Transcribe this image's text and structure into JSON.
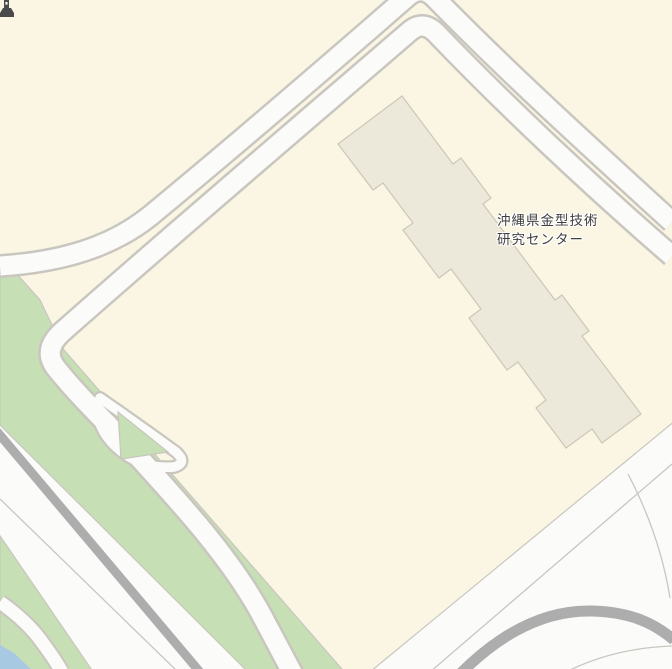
{
  "map": {
    "poi": {
      "label_line1": "沖縄県金型技術",
      "label_line2": "研究センター",
      "icon": "factory-building-icon"
    },
    "features": {
      "block": "city-block-diamond",
      "building": "research-center-building",
      "roads": [
        "dual-carriageway-northwest",
        "dual-carriageway-northeast",
        "spur-road-southwest",
        "highway-bundle-bottom-left",
        "interchange-southeast",
        "coastal-road-bottom-left"
      ],
      "landcover": [
        "green-belt-southwest",
        "green-island-loop",
        "water-corner-bottom-left"
      ]
    },
    "colors": {
      "background_cream": "#FBF6E4",
      "road_fill": "#FBFBF9",
      "road_casing": "#C9C6BF",
      "green": "#C7DFB4",
      "water": "#A7C9E2",
      "gray_road": "#ADADAD",
      "building_fill": "#ECE8DA",
      "building_stroke": "#CDC7B7",
      "label_text": "#3E3E3E"
    }
  }
}
